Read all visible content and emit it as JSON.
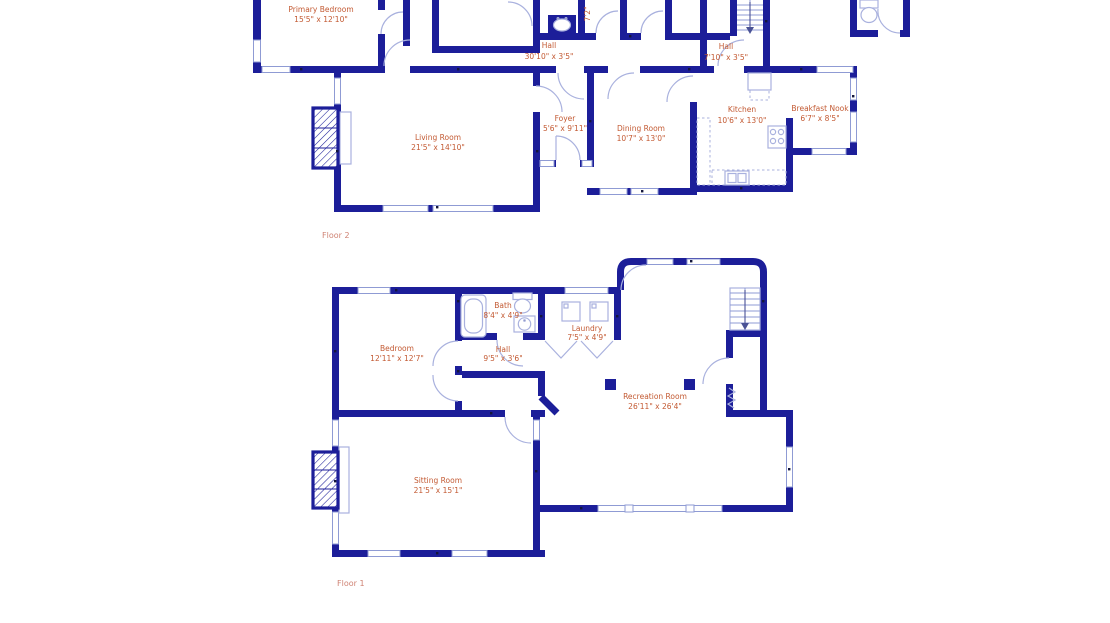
{
  "floor2": {
    "label": "Floor 2",
    "partial_dim_label": "7'2\"",
    "rooms": {
      "primary_bedroom": {
        "name": "Primary Bedroom",
        "dims": "15'5\" x 12'10\""
      },
      "hall_main": {
        "name": "Hall",
        "dims": "30'10\" x 3'5\""
      },
      "hall_small": {
        "name": "Hall",
        "dims": "7'10\" x 3'5\""
      },
      "living_room": {
        "name": "Living Room",
        "dims": "21'5\" x 14'10\""
      },
      "foyer": {
        "name": "Foyer",
        "dims": "5'6\" x 9'11\""
      },
      "dining_room": {
        "name": "Dining Room",
        "dims": "10'7\" x 13'0\""
      },
      "kitchen": {
        "name": "Kitchen",
        "dims": "10'6\" x 13'0\""
      },
      "breakfast_nook": {
        "name": "Breakfast Nook",
        "dims": "6'7\" x 8'5\""
      }
    }
  },
  "floor1": {
    "label": "Floor 1",
    "rooms": {
      "bedroom": {
        "name": "Bedroom",
        "dims": "12'11\" x 12'7\""
      },
      "bath": {
        "name": "Bath",
        "dims": "8'4\" x 4'9\""
      },
      "laundry": {
        "name": "Laundry",
        "dims": "7'5\" x 4'9\""
      },
      "hall": {
        "name": "Hall",
        "dims": "9'5\" x 3'6\""
      },
      "recreation_room": {
        "name": "Recreation Room",
        "dims": "26'11\" x 26'4\""
      },
      "sitting_room": {
        "name": "Sitting Room",
        "dims": "21'5\" x 15'1\""
      }
    }
  }
}
